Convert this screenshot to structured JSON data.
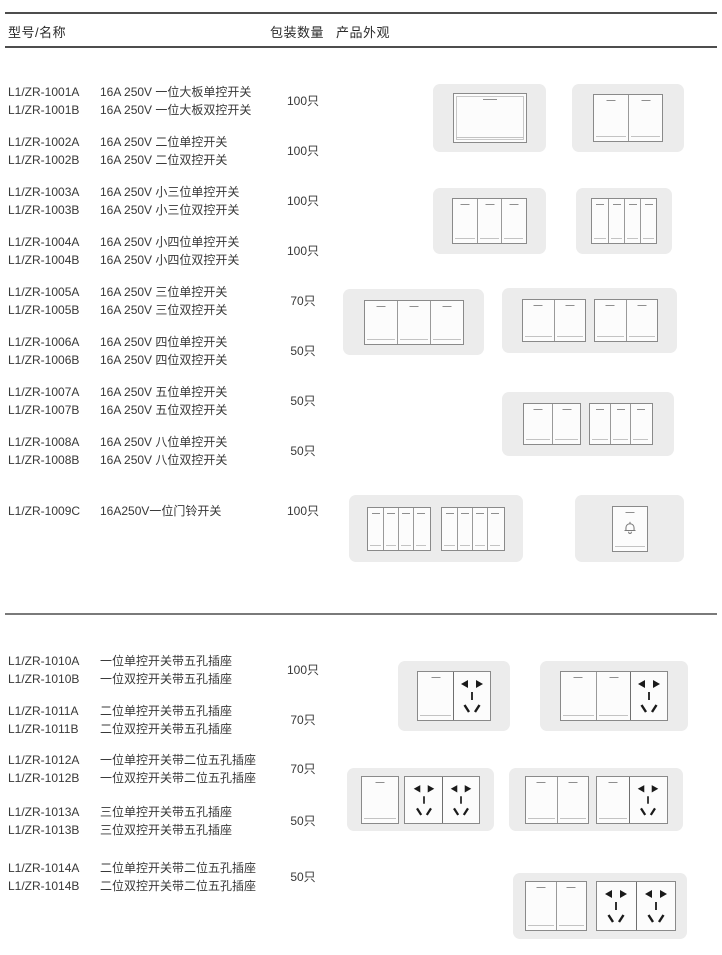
{
  "header": {
    "col_model": "型号/名称",
    "col_qty": "包装数量",
    "col_appearance": "产品外观"
  },
  "rows": [
    {
      "model_a": "L1/ZR-1001A",
      "desc_a": "16A 250V 一位大板单控开关",
      "model_b": "L1/ZR-1001B",
      "desc_b": "16A 250V 一位大板双控开关",
      "qty": "100只"
    },
    {
      "model_a": "L1/ZR-1002A",
      "desc_a": "16A 250V 二位单控开关",
      "model_b": "L1/ZR-1002B",
      "desc_b": "16A 250V 二位双控开关",
      "qty": "100只"
    },
    {
      "model_a": "L1/ZR-1003A",
      "desc_a": "16A 250V 小三位单控开关",
      "model_b": "L1/ZR-1003B",
      "desc_b": "16A 250V 小三位双控开关",
      "qty": "100只"
    },
    {
      "model_a": "L1/ZR-1004A",
      "desc_a": "16A 250V 小四位单控开关",
      "model_b": "L1/ZR-1004B",
      "desc_b": "16A 250V 小四位双控开关",
      "qty": "100只"
    },
    {
      "model_a": "L1/ZR-1005A",
      "desc_a": "16A 250V 三位单控开关",
      "model_b": "L1/ZR-1005B",
      "desc_b": "16A 250V 三位双控开关",
      "qty": "70只"
    },
    {
      "model_a": "L1/ZR-1006A",
      "desc_a": "16A 250V 四位单控开关",
      "model_b": "L1/ZR-1006B",
      "desc_b": "16A 250V 四位双控开关",
      "qty": "50只"
    },
    {
      "model_a": "L1/ZR-1007A",
      "desc_a": "16A 250V 五位单控开关",
      "model_b": "L1/ZR-1007B",
      "desc_b": "16A 250V 五位双控开关",
      "qty": "50只"
    },
    {
      "model_a": "L1/ZR-1008A",
      "desc_a": "16A 250V 八位单控开关",
      "model_b": "L1/ZR-1008B",
      "desc_b": "16A 250V 八位双控开关",
      "qty": "50只"
    },
    {
      "model_a": "L1/ZR-1009C",
      "desc_a": "16A250V一位门铃开关",
      "qty": "100只"
    },
    {
      "model_a": "L1/ZR-1010A",
      "desc_a": "一位单控开关带五孔插座",
      "model_b": "L1/ZR-1010B",
      "desc_b": "一位双控开关带五孔插座",
      "qty": "100只"
    },
    {
      "model_a": "L1/ZR-1011A",
      "desc_a": "二位单控开关带五孔插座",
      "model_b": "L1/ZR-1011B",
      "desc_b": "二位双控开关带五孔插座",
      "qty": "70只"
    },
    {
      "model_a": "L1/ZR-1012A",
      "desc_a": "一位单控开关带二位五孔插座",
      "model_b": "L1/ZR-1012B",
      "desc_b": "一位双控开关带二位五孔插座",
      "qty": "70只"
    },
    {
      "model_a": "L1/ZR-1013A",
      "desc_a": "三位单控开关带五孔插座",
      "model_b": "L1/ZR-1013B",
      "desc_b": "三位双控开关带五孔插座",
      "qty": "50只"
    },
    {
      "model_a": "L1/ZR-1014A",
      "desc_a": "二位单控开关带二位五孔插座",
      "model_b": "L1/ZR-1014B",
      "desc_b": "二位双控开关带二位五孔插座",
      "qty": "50只"
    }
  ],
  "products": {
    "p1001": "one-gang-big-plate-switch",
    "p1002": "two-gang-switch",
    "p1003": "small-three-gang-switch",
    "p1004": "small-four-gang-switch",
    "p1005": "three-gang-switch",
    "p1006": "four-gang-switch",
    "p1007": "five-gang-switch",
    "p1008": "eight-gang-switch",
    "p1009": "doorbell-switch",
    "p1010": "one-switch-with-five-hole-socket",
    "p1011": "two-switch-with-five-hole-socket",
    "p1012": "one-switch-with-two-five-hole-sockets",
    "p1013": "three-switch-with-five-hole-socket",
    "p1014": "two-switch-with-two-five-hole-sockets"
  },
  "colors": {
    "plate": "#ececec",
    "rule_dark": "#4d4d4d",
    "rule_divider": "#7a7a7a",
    "socket_hole": "#1a1a1a",
    "text": "#383838"
  }
}
